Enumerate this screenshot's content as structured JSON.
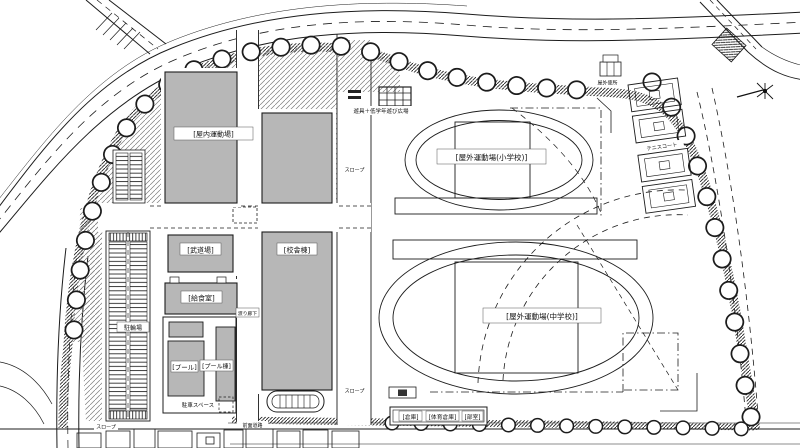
{
  "drawing": {
    "type": "school-site-plan",
    "labels": {
      "indoor_gym": "[屋内運動場]",
      "martial_arts_hall": "[武道場]",
      "school_building": "[校舎棟]",
      "kitchen": "[給食室]",
      "pool": "[プール]",
      "pool_building": "[プール棟]",
      "covered_walkway": "渡り廊下",
      "bicycle_parking": "駐輪場",
      "parking_space": "駐車スペース",
      "slope": "スロープ",
      "play_plaza": "遊具＋低学年遊び広場",
      "field_elementary": "[屋外運動場(小学校)]",
      "field_junior_high": "[屋外運動場(中学校)]",
      "tennis_court": "テニスコート",
      "outdoor_toilet": "屋外便所",
      "storage": "[倉庫]",
      "gym_storage": "[体育倉庫]",
      "club_rooms": "[部室]",
      "front_road": "前面道路"
    },
    "colors": {
      "building_fill": "#b7b7b7",
      "line": "#1c1c1c",
      "background": "#ffffff"
    }
  }
}
